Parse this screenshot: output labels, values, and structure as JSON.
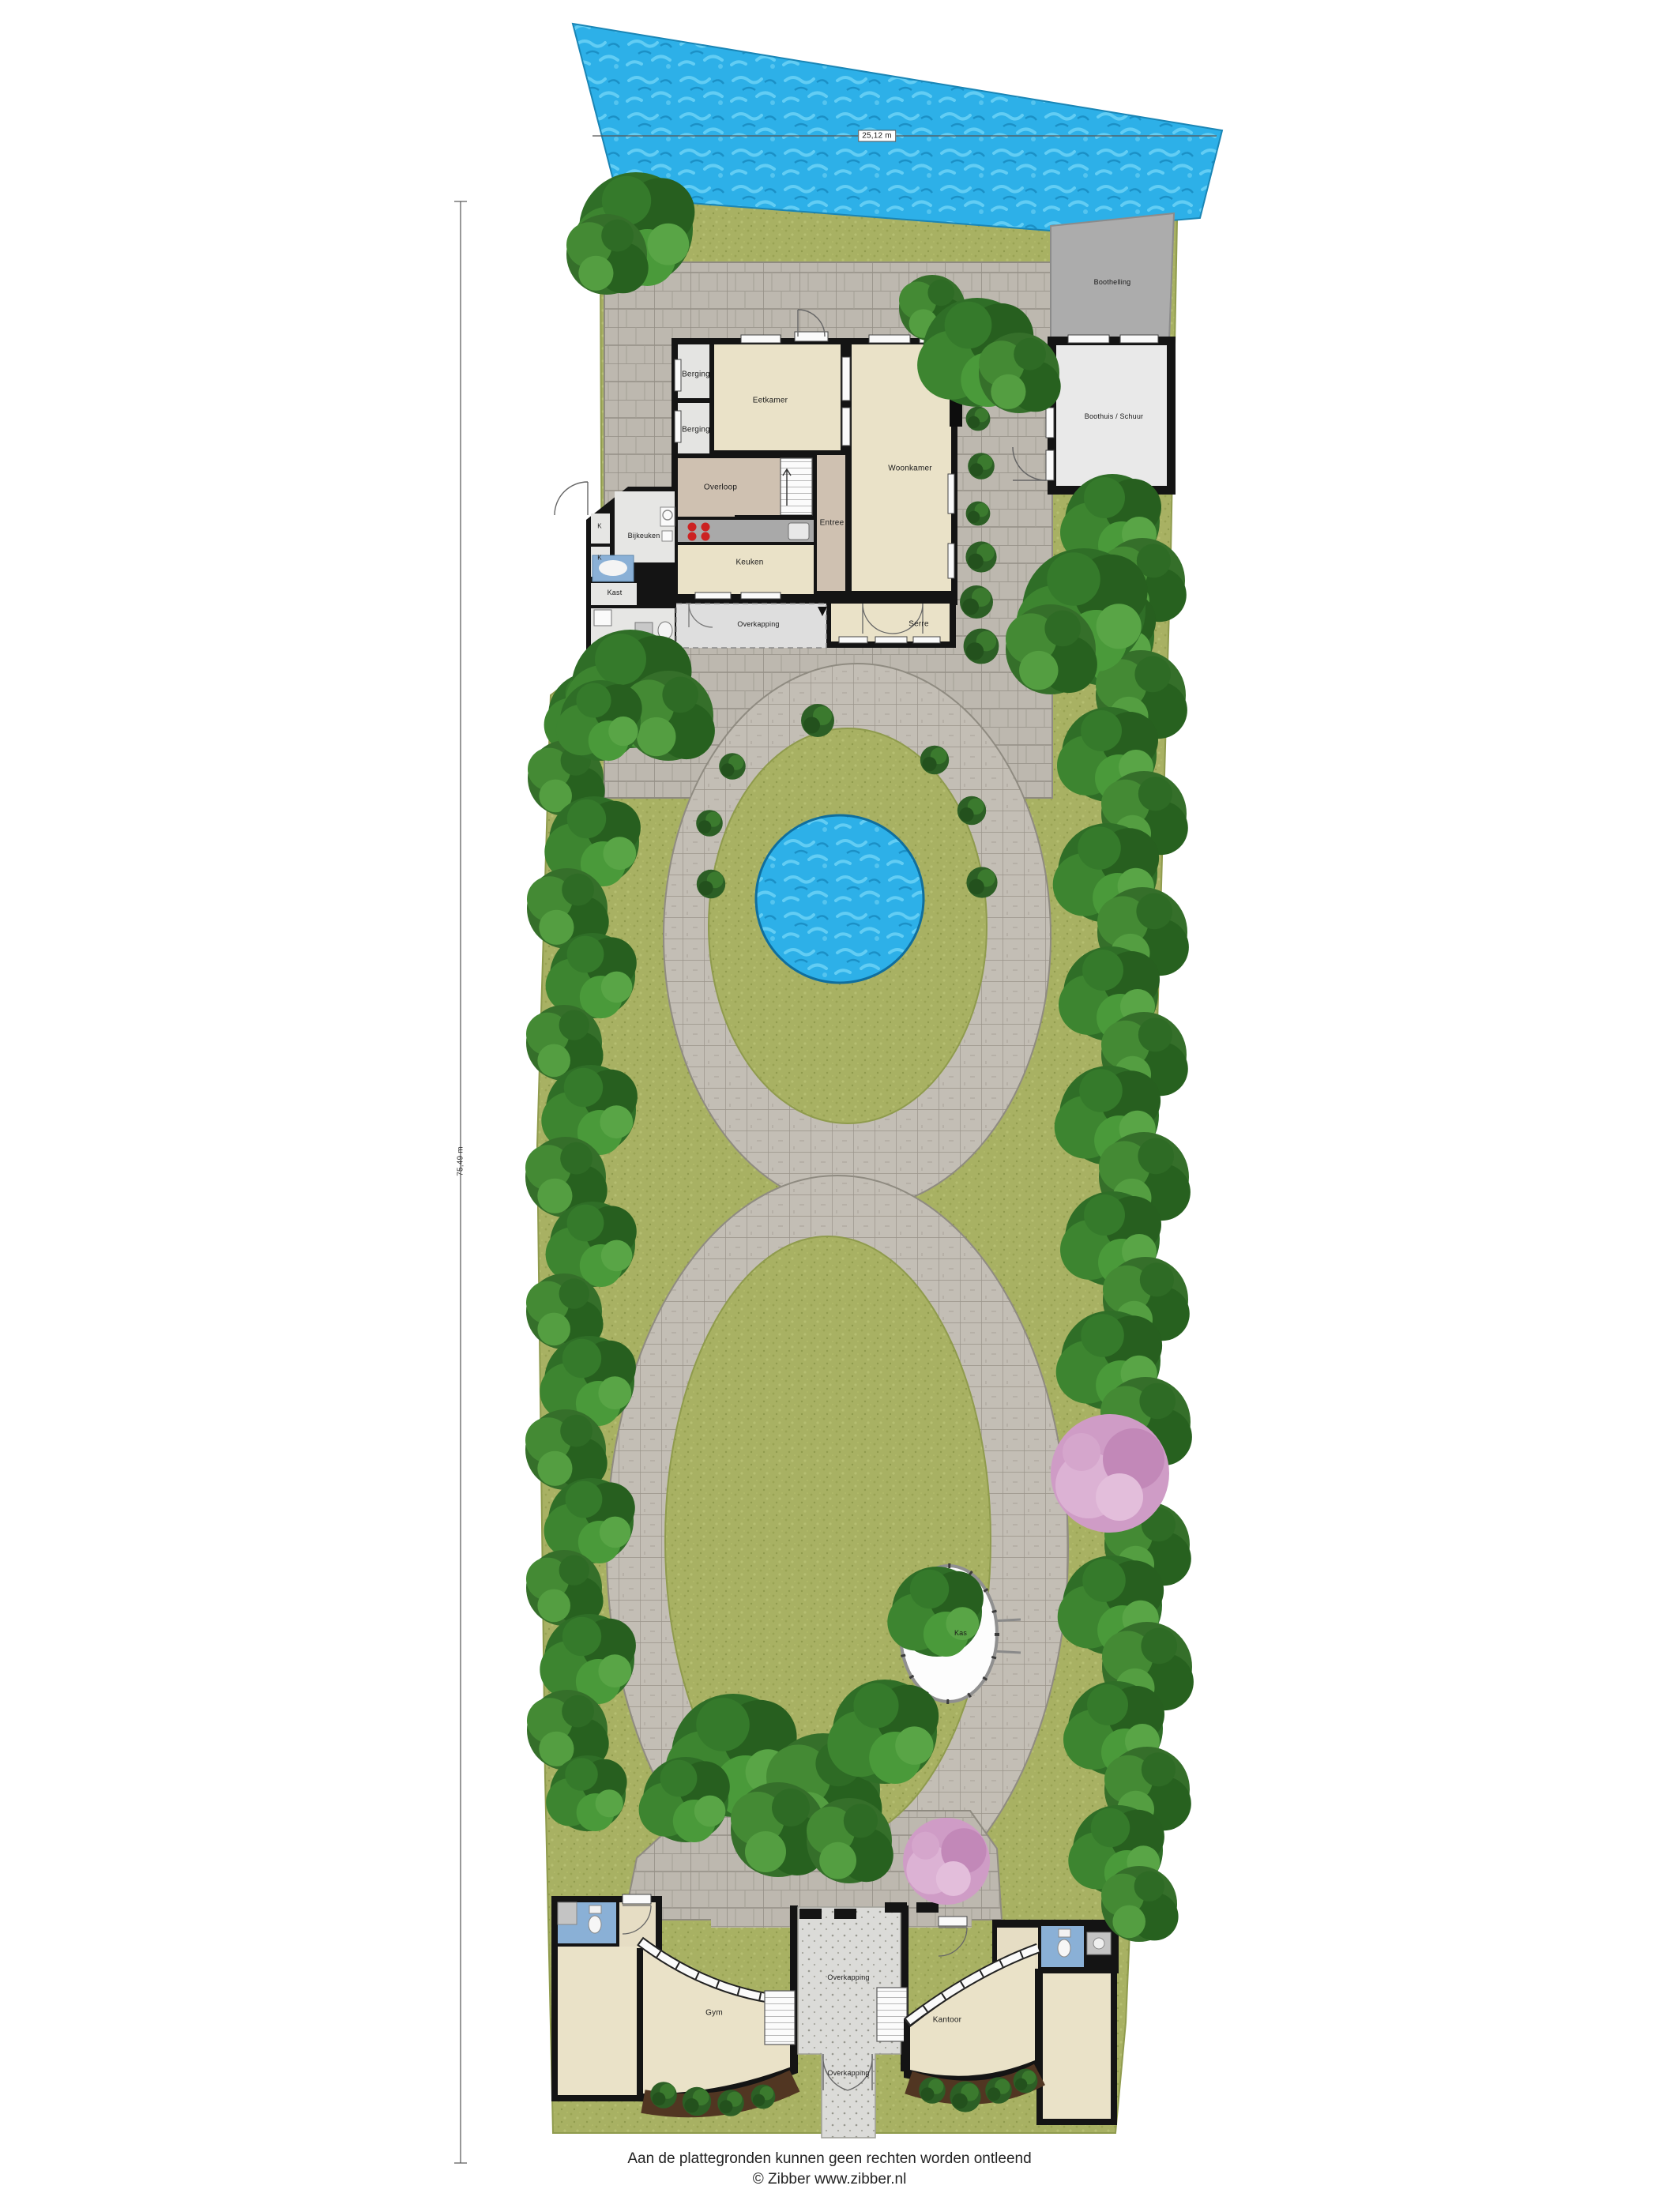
{
  "site": {
    "water_dimension": "25,12 m",
    "site_depth_dimension": "75,49 m",
    "areas": {
      "boothelling": "Boothelling",
      "boothuis": "Boothuis / Schuur",
      "kas": "Kas"
    }
  },
  "house": {
    "rooms": {
      "berging1": "Berging",
      "berging2": "Berging",
      "eetkamer": "Eetkamer",
      "woonkamer": "Woonkamer",
      "overloop": "Overloop",
      "entree": "Entree",
      "bijkeuken": "Bijkeuken",
      "keuken": "Keuken",
      "kast": "Kast",
      "closet1": "K",
      "closet2": "K",
      "overkapping": "Overkapping",
      "serre": "Serre"
    }
  },
  "outbuilding": {
    "rooms": {
      "gym": "Gym",
      "kantoor": "Kantoor",
      "overkapping_noord": "Overkapping",
      "overkapping_zuid": "Overkapping"
    }
  },
  "footer": {
    "line1": "Aan de plattegronden kunnen geen rechten worden ontleend",
    "line2": "© Zibber www.zibber.nl"
  },
  "palette": {
    "water": "#2db0e8",
    "grass": "#a8b163",
    "paving": "#c1bcb3",
    "walls": "#141414",
    "room_beige": "#eae2c8",
    "room_gray": "#e4e4e2",
    "room_taupe": "#cfc1b1",
    "bathroom_blue": "#8ab0d6",
    "tree_green": "#2f6e27",
    "blossom_pink": "#cf9cc6"
  }
}
